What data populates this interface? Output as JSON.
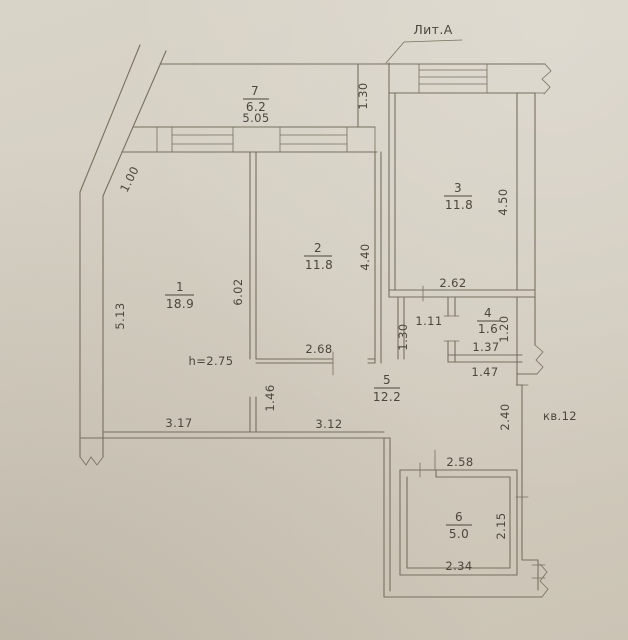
{
  "meta": {
    "building_label": "Лит.А",
    "apartment_label": "кв.12",
    "ceiling_height_note": "h=2.75"
  },
  "rooms": {
    "r1": {
      "number": "1",
      "area": "18.9"
    },
    "r2": {
      "number": "2",
      "area": "11.8"
    },
    "r3": {
      "number": "3",
      "area": "11.8"
    },
    "r4": {
      "number": "4",
      "area": "1.6"
    },
    "r5": {
      "number": "5",
      "area": "12.2"
    },
    "r6": {
      "number": "6",
      "area": "5.0"
    },
    "r7": {
      "number": "7",
      "area": "6.2"
    }
  },
  "dims": {
    "balcony_width": "5.05",
    "balcony_depth": "1.30",
    "diagonal_wall": "1.00",
    "room1_left": "5.13",
    "room1_divider": "6.02",
    "room1_bottom": "3.17",
    "room2_height": "4.40",
    "room2_bottom": "2.68",
    "room3_height": "4.50",
    "room3_bottom": "2.62",
    "corridor_width": "1.11",
    "corridor_height": "1.30",
    "wc_width": "1.37",
    "wc_height": "1.20",
    "wc_bottom": "1.47",
    "hall_height": "1.46",
    "hall_bottom": "3.12",
    "entry_height": "2.40",
    "room6_top": "2.58",
    "room6_height": "2.15",
    "room6_bottom": "2.34"
  },
  "colors": {
    "paper": "#d4cec1",
    "ink": "#77705f",
    "text": "#4c463c"
  }
}
